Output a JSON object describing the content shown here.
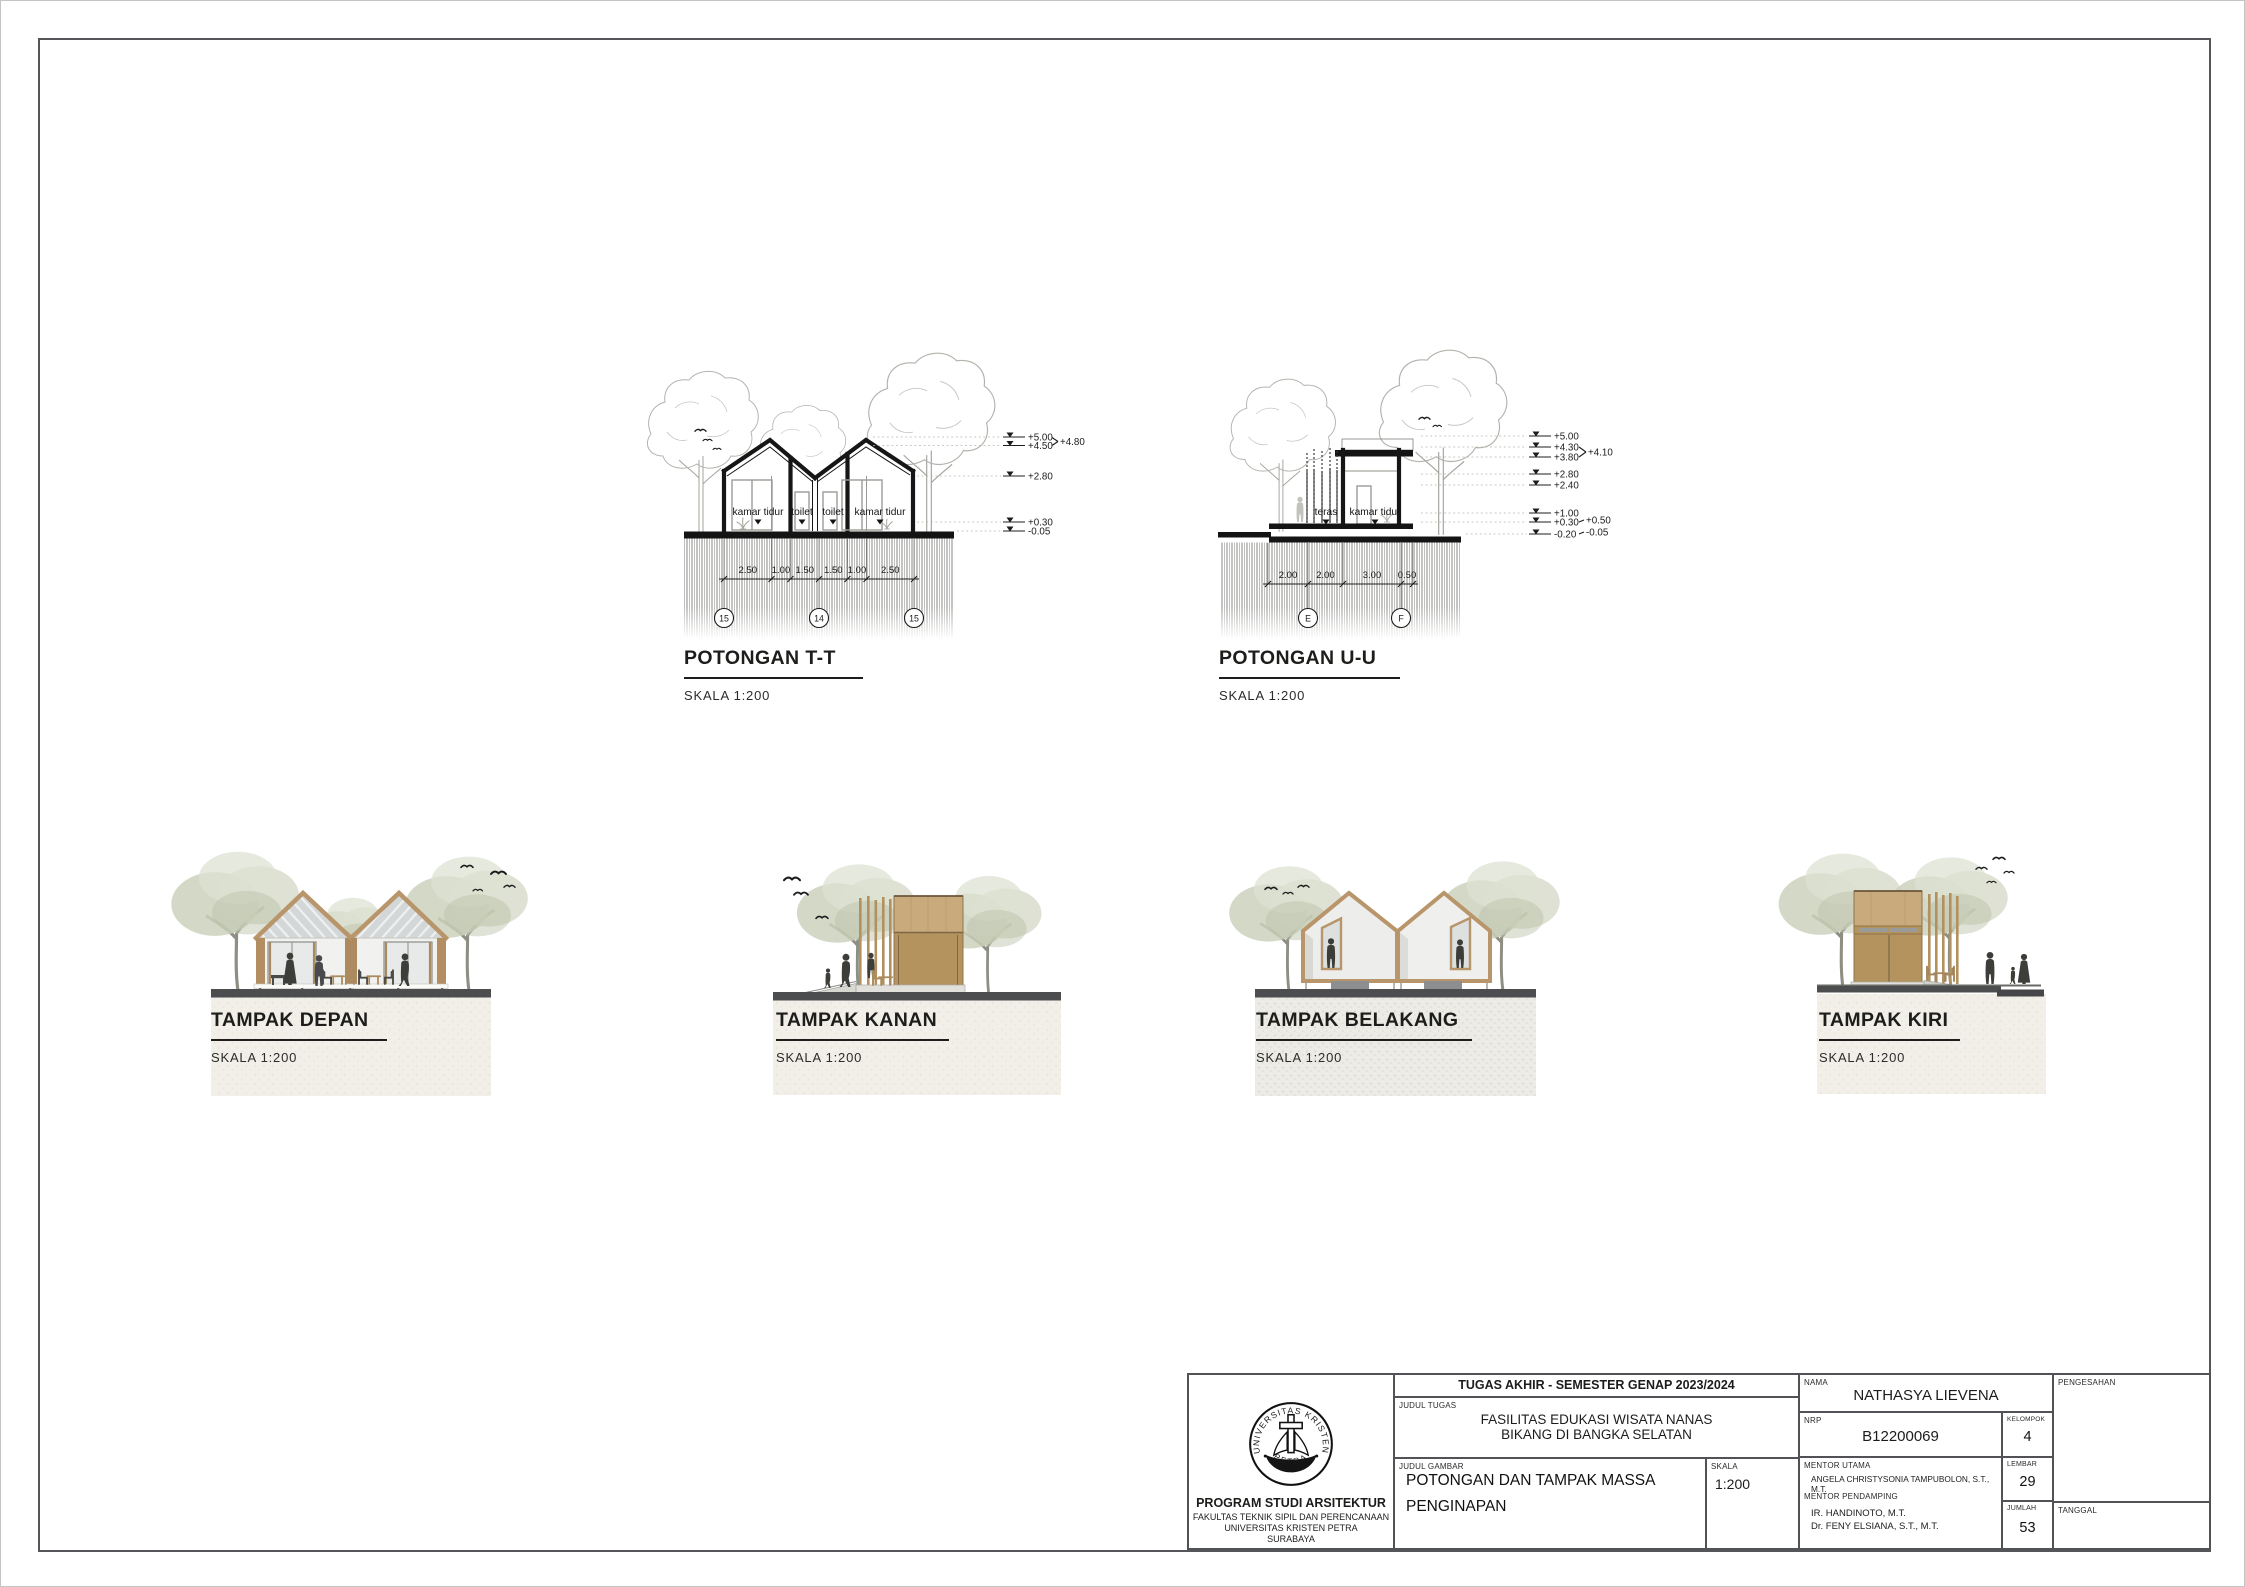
{
  "potongan_tt": {
    "title": "POTONGAN T-T",
    "scale": "SKALA 1:200",
    "room_labels": [
      "kamar tidur",
      "toilet",
      "toilet",
      "kamar tidur"
    ],
    "levels": [
      "+5.00",
      "+4.50",
      "+4.80",
      "+2.80",
      "+0.30",
      "-0.05"
    ],
    "dimensions": [
      "2.50",
      "1.00",
      "1.50",
      "1.50",
      "1.00",
      "2.50"
    ],
    "grid_bubbles": [
      "15",
      "14",
      "15"
    ]
  },
  "potongan_uu": {
    "title": "POTONGAN U-U",
    "scale": "SKALA 1:200",
    "room_labels": [
      "teras",
      "kamar tidur"
    ],
    "levels": [
      "+5.00",
      "+4.30",
      "+4.10",
      "+3.80",
      "+2.80",
      "+2.40",
      "+1.00",
      "+0.50",
      "+0.30",
      "-0.05",
      "-0.20"
    ],
    "dimensions": [
      "2.00",
      "2.00",
      "3.00",
      "0.50"
    ],
    "grid_bubbles": [
      "E",
      "F"
    ]
  },
  "tampak": [
    {
      "title": "TAMPAK DEPAN",
      "scale": "SKALA 1:200"
    },
    {
      "title": "TAMPAK KANAN",
      "scale": "SKALA 1:200"
    },
    {
      "title": "TAMPAK BELAKANG",
      "scale": "SKALA 1:200"
    },
    {
      "title": "TAMPAK KIRI",
      "scale": "SKALA 1:200"
    }
  ],
  "titleblock": {
    "header": "TUGAS AKHIR - SEMESTER GENAP 2023/2024",
    "judul_tugas_label": "JUDUL TUGAS",
    "judul_tugas_line1": "FASILITAS EDUKASI WISATA NANAS",
    "judul_tugas_line2": "BIKANG DI BANGKA SELATAN",
    "judul_gambar_label": "JUDUL GAMBAR",
    "judul_gambar_line1": "POTONGAN DAN TAMPAK MASSA",
    "judul_gambar_line2": "PENGINAPAN",
    "skala_label": "SKALA",
    "skala_value": "1:200",
    "nama_label": "NAMA",
    "nama_value": "NATHASYA LIEVENA",
    "nrp_label": "NRP",
    "nrp_value": "B12200069",
    "kelompok_label": "KELOMPOK",
    "kelompok_value": "4",
    "mentor_utama_label": "MENTOR UTAMA",
    "mentor_utama_value": "ANGELA CHRISTYSONIA TAMPUBOLON, S.T., M.T.",
    "mentor_pendamping_label": "MENTOR PENDAMPING",
    "mentor_pendamping_1": "IR. HANDINOTO, M.T.",
    "mentor_pendamping_2": "Dr. FENY ELSIANA, S.T., M.T.",
    "lembar_label": "LEMBAR",
    "lembar_value": "29",
    "jumlah_label": "JUMLAH",
    "jumlah_value": "53",
    "pengesahan_label": "PENGESAHAN",
    "tanggal_label": "TANGGAL",
    "logo_top": "UNIVERSITAS KRISTEN",
    "logo_bottom": "PETRA",
    "institution_line1": "PROGRAM STUDI ARSITEKTUR",
    "institution_line2": "FAKULTAS TEKNIK SIPIL DAN PERENCANAAN",
    "institution_line3": "UNIVERSITAS KRISTEN PETRA",
    "institution_line4": "SURABAYA"
  },
  "colors": {
    "wood": "#b8956a",
    "wood_panel_light": "#c9aa7d",
    "wood_panel_dark": "#b5935f",
    "roof_gray": "#d4d7d8",
    "ground_band": "#4c4d4f",
    "tree_sage": "#ccd1bc",
    "silhouette": "#3d3d3a",
    "line_black": "#161616"
  }
}
